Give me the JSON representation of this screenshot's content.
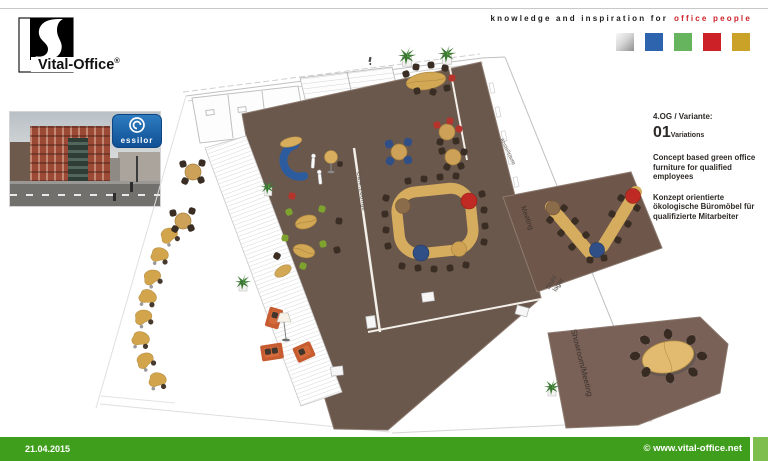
{
  "header": {
    "logo": {
      "brand": "Vital-Office",
      "registered": "®"
    },
    "tagline": {
      "black": "knowledge and inspiration for",
      "red": "office people"
    },
    "palette": {
      "silver": "#c7c7c7",
      "blue": "#2e64ad",
      "green": "#66b55e",
      "red": "#cc2127",
      "gold": "#c9a227"
    }
  },
  "photo": {
    "essilor": "essilor"
  },
  "info_panel": {
    "variant_label": "4.OG / Variante:",
    "variant_number": "01",
    "variant_unit": "Variations",
    "description_en": "Concept based green office furniture for qualified employees",
    "description_de": "Konzept orientierte ökologische Büromöbel für qualifizierte Mitarbeiter"
  },
  "floorplan": {
    "labels": {
      "meeting": "Meeting",
      "stuhl_lager_line1": "Stuhl",
      "stuhl_lager_line2": "lager",
      "showroom": "Showroom/Meeting",
      "cafe_lounge": "Cafe.Lounge",
      "storage": "Abstellraum"
    },
    "colors": {
      "main_floor": "#6b584d",
      "meeting_floor": "#6e564a",
      "showroom_floor": "#796158",
      "desk_wood": "#d6ac5e",
      "accent_red": "#bf2b24",
      "accent_blue": "#2f4f86",
      "sofa_orange": "#c65c30",
      "chair_green": "#7da32e",
      "plant_green": "#3c7a33"
    }
  },
  "footer": {
    "date": "21.04.2015",
    "website": "© www.vital-office.net",
    "bar_color": "#3f9e1c"
  }
}
